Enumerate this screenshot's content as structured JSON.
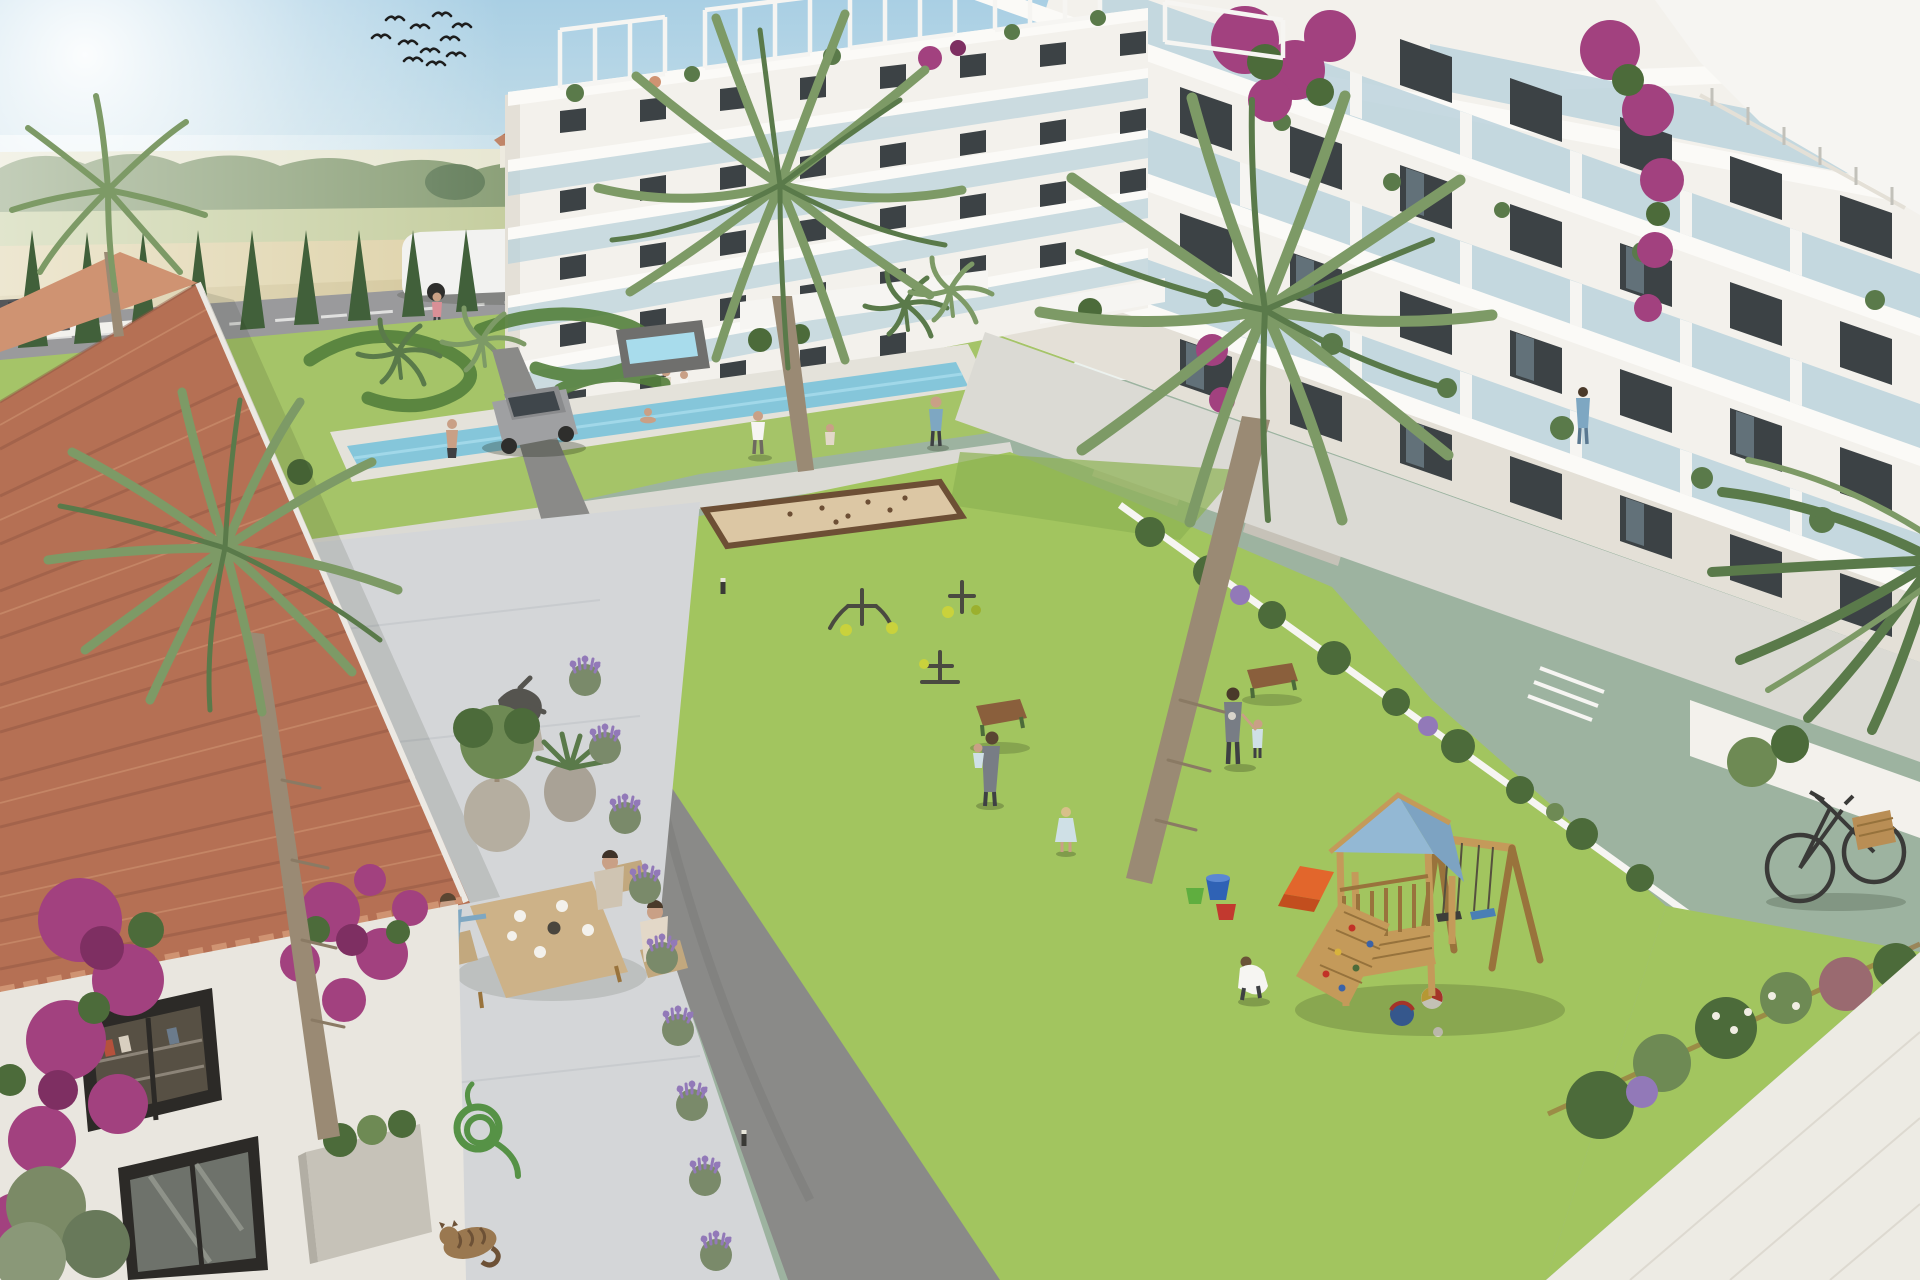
{
  "meta": {
    "title": "Aerial 3D architectural render of a Mediterranean residential complex: white apartment wings with glass balconies around a green courtyard with playground, petanque court and pool, a terracotta-roofed house in the foreground, farmland and a road behind",
    "image_type": "architectural-render",
    "no_visible_text": true
  },
  "palette": {
    "sky_top": "#a9cfe4",
    "sky_horizon": "#edf3ef",
    "glare": "#ffffff",
    "field_far": "#e4e3cb",
    "field_wheat": "#d8ca99",
    "field_wheat2": "#cbbc88",
    "field_green": "#bcc690",
    "field_green2": "#a9bb80",
    "treeline": "#6d8758",
    "tree_dark": "#4e6c44",
    "farm_wall": "#eae6da",
    "farm_roof": "#b5714f",
    "road": "#9a9a9c",
    "road_line": "#ececeb",
    "fence": "#f2f1ed",
    "cypress": "#41603a",
    "garden_lawn": "#a5c468",
    "hedge": "#53803c",
    "pool_water": "#85c6da",
    "pool_lane": "#a8dcec",
    "pool_deck": "#e4e2da",
    "stone": "#6f6f6d",
    "building": "#f3f1ec",
    "building_shade": "#e4e0d7",
    "slab": "#fbfaf7",
    "glass": "#b9d2dc",
    "window": "#3c4245",
    "window_lite": "#8299a4",
    "white": "#f6f5f2",
    "lawn": "#a2c55f",
    "lawn_shade": "#8db253",
    "path": "#dbdad4",
    "path_edge": "#c2c1ba",
    "drive": "#8a8a88",
    "terrace_white": "#edebe4",
    "sand": "#dcc7a4",
    "sand_border": "#6d4f35",
    "wood": "#c49a5a",
    "wood_dark": "#99733c",
    "roof_blue": "#93b8d4",
    "roof_blue_dark": "#7da3c2",
    "slide_orange": "#e2662c",
    "swing_blue": "#4a7fb5",
    "bench_wood": "#8a5f3c",
    "palm": "#7d9a66",
    "palm_dark": "#5a7a4a",
    "trunk": "#9a8a74",
    "tile": "#b57054",
    "tile_light": "#cf9372",
    "tile_dark": "#8e5540",
    "fascia": "#ece9e3",
    "house_wall": "#e9e6df",
    "terrace_pave": "#d4d6d8",
    "bougainvillea": "#a2417f",
    "bougain_dark": "#7e2f62",
    "lavender": "#9279b8",
    "lavender_leaf": "#7a8a6a",
    "foliage": "#6e8a54",
    "foliage_dark": "#4c6b3a",
    "statue": "#55544f",
    "pot": "#b5aea0",
    "pot_dark": "#a9a296",
    "planter": "#c6c2b8",
    "soil": "#7c7460",
    "skin": "#c9a086",
    "shirt_blue": "#7ea7c2",
    "shirt_grey": "#787d85",
    "dress_blue": "#cfe0e6",
    "cloth_light": "#e3d8c8",
    "cloth_tan": "#cfc4b2",
    "pants": "#3e4043",
    "pink": "#d98f96",
    "cat_fur": "#9a7850",
    "cat_stripe": "#6d5136",
    "hose": "#569246",
    "suv": "#9fa0a2",
    "truck": "#f2f2f0",
    "car_red": "#c23227",
    "car_red_dark": "#9e2a1f",
    "vehicle_glass": "#3f464b",
    "wheel": "#2e2e2c",
    "logo_red": "#cc4a30",
    "bike": "#3a3a38",
    "basket": "#b98e55",
    "bucket_blue": "#2f62b5",
    "bucket_green": "#5fae3f",
    "bucket_red": "#c2392f",
    "ball_blue": "#3b63a8",
    "ball_sand": "#d8b33c",
    "shadow": "#1a2210",
    "table_wood": "#cdb288"
  },
  "scene": {
    "sky": {
      "birds_in_flock": 11,
      "sun": "top-left glare"
    },
    "background": {
      "farmland": "alternating wheat and green field bands",
      "farmhouses": 2,
      "treeline": true
    },
    "road": {
      "vehicles": [
        "white van",
        "white box truck with red logo",
        "red car",
        "dark car at edge"
      ],
      "cypress_hedge_trees": 21,
      "pedestrian": 1,
      "parking_lines": 3
    },
    "resort_amenities": {
      "ornamental_garden_swirl_hedges": 3,
      "lap_pool_swimmers": 2,
      "fountain": true,
      "petanque_court": true,
      "outdoor_gym_stations": 3,
      "benches": 2,
      "bollard_lights": 4,
      "playground": {
        "tower_roof_color": "blue",
        "slide_color": "orange",
        "swings": 2,
        "climbing_wall": true,
        "toys": [
          "3 buckets",
          "beach ball",
          "blue ball",
          "small ball"
        ]
      }
    },
    "buildings": {
      "left_wing": {
        "floors": 5,
        "rooftop_pergolas": 4
      },
      "right_wing": {
        "floors": 5,
        "rooftop_stair_structure": true,
        "bougainvillea_cascades": 3,
        "balcony_residents": 1
      },
      "style": "white modern apartments, glass balustrades, planted balconies"
    },
    "foreground_house": {
      "style": "Spanish house with terracotta S-tile roof",
      "terrace": {
        "diners_at_table": 3,
        "statue": 1,
        "potted_olive": 1,
        "agave_pot": 1,
        "citrus_tree": 1,
        "lavender_bushes": 9
      },
      "details": [
        "bougainvillea on walls",
        "bookshelf window",
        "french door",
        "concrete planter",
        "coiled garden hose",
        "sleeping tabby cat"
      ]
    },
    "courtyard_people": [
      "adult playing with child",
      "path walker",
      "woman carrying child",
      "toddler in blue dress",
      "parent holding child's hand",
      "crouching boy with balls"
    ],
    "other": [
      "parked silver SUV",
      "bicycle with wicker basket",
      "four large palm trees",
      "mini palms"
    ]
  }
}
